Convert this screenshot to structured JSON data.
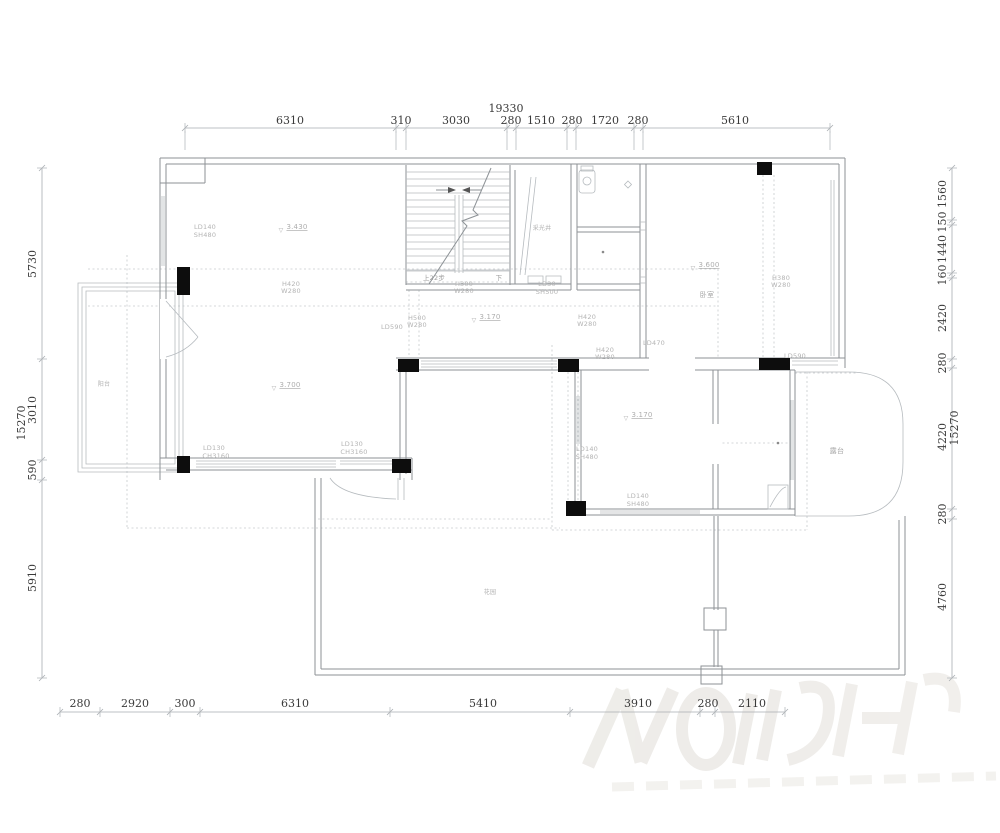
{
  "document": {
    "kind": "floor-plan-cad-drawing",
    "background": "#ffffff"
  },
  "drawing": {
    "line_color": "#8d9296",
    "thin_line_color": "#b6bbbf",
    "dash_color": "#c6cacd",
    "dim_line_color": "#a9adb1",
    "dim_text_color": "#3a3a3a",
    "annot_text_color": "#b3b3b3",
    "column_color": "#0d0d0d",
    "watermark_color": "#eae8e4"
  },
  "dimensions": {
    "top": {
      "total": "19330",
      "segments": [
        "6310",
        "310",
        "3030",
        "280",
        "1510",
        "280",
        "1720",
        "280",
        "5610"
      ]
    },
    "bottom": {
      "segments": [
        "280",
        "2920",
        "300",
        "6310",
        "5410",
        "3910",
        "280",
        "2110"
      ]
    },
    "left": {
      "total": "15270",
      "segments": [
        "5730",
        "3010",
        "590",
        "5910"
      ]
    },
    "right": {
      "total": "15270",
      "segments": [
        "1560",
        "150",
        "1440",
        "160",
        "2420",
        "280",
        "4220",
        "280",
        "4760"
      ]
    }
  },
  "elevations": [
    "3.430",
    "3.600",
    "3.170",
    "3.170",
    "3.700"
  ],
  "openings": [
    "LD140 SH480",
    "LD30 SH500",
    "LD590",
    "LD470",
    "LD590",
    "H300 W280",
    "H420 W280",
    "H500 W280",
    "H420 W280",
    "H420 W280",
    "H380 W280",
    "LD140 SH480",
    "LD140 SH480",
    "LD130 CH3160",
    "LD130 CH3160"
  ],
  "rooms": [
    "阳台",
    "卧室",
    "露台",
    "花园",
    "采光井"
  ],
  "stairs": {
    "up_label": "上22步",
    "down_label": "下"
  },
  "texts": [
    {
      "name": "dim-top-total",
      "text": "19330",
      "x": 506,
      "y": 112,
      "size": 11,
      "color": "#3a3a3a",
      "serif": true
    },
    {
      "name": "dim-top-1",
      "text": "6310",
      "x": 290,
      "y": 124,
      "size": 11,
      "color": "#3a3a3a",
      "serif": true
    },
    {
      "name": "dim-top-2",
      "text": "310",
      "x": 401,
      "y": 124,
      "size": 11,
      "color": "#3a3a3a",
      "serif": true
    },
    {
      "name": "dim-top-3",
      "text": "3030",
      "x": 456,
      "y": 124,
      "size": 11,
      "color": "#3a3a3a",
      "serif": true
    },
    {
      "name": "dim-top-4",
      "text": "280",
      "x": 511,
      "y": 124,
      "size": 11,
      "color": "#3a3a3a",
      "serif": true
    },
    {
      "name": "dim-top-5",
      "text": "1510",
      "x": 541,
      "y": 124,
      "size": 11,
      "color": "#3a3a3a",
      "serif": true
    },
    {
      "name": "dim-top-6",
      "text": "280",
      "x": 572,
      "y": 124,
      "size": 11,
      "color": "#3a3a3a",
      "serif": true
    },
    {
      "name": "dim-top-7",
      "text": "1720",
      "x": 605,
      "y": 124,
      "size": 11,
      "color": "#3a3a3a",
      "serif": true
    },
    {
      "name": "dim-top-8",
      "text": "280",
      "x": 638,
      "y": 124,
      "size": 11,
      "color": "#3a3a3a",
      "serif": true
    },
    {
      "name": "dim-top-9",
      "text": "5610",
      "x": 735,
      "y": 124,
      "size": 11,
      "color": "#3a3a3a",
      "serif": true
    },
    {
      "name": "dim-bottom-1",
      "text": "280",
      "x": 80,
      "y": 707,
      "size": 11,
      "color": "#3a3a3a",
      "serif": true
    },
    {
      "name": "dim-bottom-2",
      "text": "2920",
      "x": 135,
      "y": 707,
      "size": 11,
      "color": "#3a3a3a",
      "serif": true
    },
    {
      "name": "dim-bottom-3",
      "text": "300",
      "x": 185,
      "y": 707,
      "size": 11,
      "color": "#3a3a3a",
      "serif": true
    },
    {
      "name": "dim-bottom-4",
      "text": "6310",
      "x": 295,
      "y": 707,
      "size": 11,
      "color": "#3a3a3a",
      "serif": true
    },
    {
      "name": "dim-bottom-5",
      "text": "5410",
      "x": 483,
      "y": 707,
      "size": 11,
      "color": "#3a3a3a",
      "serif": true
    },
    {
      "name": "dim-bottom-6",
      "text": "3910",
      "x": 638,
      "y": 707,
      "size": 11,
      "color": "#3a3a3a",
      "serif": true
    },
    {
      "name": "dim-bottom-7",
      "text": "280",
      "x": 708,
      "y": 707,
      "size": 11,
      "color": "#3a3a3a",
      "serif": true
    },
    {
      "name": "dim-bottom-8",
      "text": "2110",
      "x": 752,
      "y": 707,
      "size": 11,
      "color": "#3a3a3a",
      "serif": true
    },
    {
      "name": "dim-left-total",
      "text": "15270",
      "x": 25,
      "y": 423,
      "size": 11,
      "color": "#3a3a3a",
      "serif": true,
      "rot": -90
    },
    {
      "name": "dim-left-1",
      "text": "5730",
      "x": 36,
      "y": 264,
      "size": 11,
      "color": "#3a3a3a",
      "serif": true,
      "rot": -90
    },
    {
      "name": "dim-left-2",
      "text": "3010",
      "x": 36,
      "y": 410,
      "size": 11,
      "color": "#3a3a3a",
      "serif": true,
      "rot": -90
    },
    {
      "name": "dim-left-3",
      "text": "590",
      "x": 36,
      "y": 470,
      "size": 11,
      "color": "#3a3a3a",
      "serif": true,
      "rot": -90
    },
    {
      "name": "dim-left-4",
      "text": "5910",
      "x": 36,
      "y": 578,
      "size": 11,
      "color": "#3a3a3a",
      "serif": true,
      "rot": -90
    },
    {
      "name": "dim-right-1",
      "text": "1560",
      "x": 946,
      "y": 194,
      "size": 11,
      "color": "#3a3a3a",
      "serif": true,
      "rot": -90
    },
    {
      "name": "dim-right-2",
      "text": "150",
      "x": 946,
      "y": 222,
      "size": 11,
      "color": "#3a3a3a",
      "serif": true,
      "rot": -90
    },
    {
      "name": "dim-right-3",
      "text": "1440",
      "x": 946,
      "y": 249,
      "size": 11,
      "color": "#3a3a3a",
      "serif": true,
      "rot": -90
    },
    {
      "name": "dim-right-4",
      "text": "160",
      "x": 946,
      "y": 275,
      "size": 11,
      "color": "#3a3a3a",
      "serif": true,
      "rot": -90
    },
    {
      "name": "dim-right-5",
      "text": "2420",
      "x": 946,
      "y": 318,
      "size": 11,
      "color": "#3a3a3a",
      "serif": true,
      "rot": -90
    },
    {
      "name": "dim-right-6",
      "text": "280",
      "x": 946,
      "y": 363,
      "size": 11,
      "color": "#3a3a3a",
      "serif": true,
      "rot": -90
    },
    {
      "name": "dim-right-7",
      "text": "4220",
      "x": 946,
      "y": 437,
      "size": 11,
      "color": "#3a3a3a",
      "serif": true,
      "rot": -90
    },
    {
      "name": "dim-right-total",
      "text": "15270",
      "x": 958,
      "y": 428,
      "size": 11,
      "color": "#3a3a3a",
      "serif": true,
      "rot": -90
    },
    {
      "name": "dim-right-8",
      "text": "280",
      "x": 946,
      "y": 514,
      "size": 11,
      "color": "#3a3a3a",
      "serif": true,
      "rot": -90
    },
    {
      "name": "dim-right-9",
      "text": "4760",
      "x": 946,
      "y": 597,
      "size": 11,
      "color": "#3a3a3a",
      "serif": true,
      "rot": -90
    },
    {
      "name": "label-window-ld140-a1",
      "text": "LD140",
      "x": 205,
      "y": 229,
      "size": 6.5
    },
    {
      "name": "label-window-ld140-a2",
      "text": "SH480",
      "x": 205,
      "y": 237,
      "size": 6.5
    },
    {
      "name": "elev-living",
      "text": "3.430",
      "x": 297,
      "y": 229,
      "size": 7,
      "color": "#adadad",
      "u": true
    },
    {
      "name": "elev-living-mark",
      "text": "▽",
      "x": 281,
      "y": 232,
      "size": 6,
      "color": "#adadad"
    },
    {
      "name": "label-h420-a1",
      "text": "H420",
      "x": 291,
      "y": 286,
      "size": 6.5
    },
    {
      "name": "label-h420-a2",
      "text": "W280",
      "x": 291,
      "y": 293,
      "size": 6.5
    },
    {
      "name": "label-h300-1",
      "text": "H300",
      "x": 464,
      "y": 286,
      "size": 6.5
    },
    {
      "name": "label-h300-2",
      "text": "W280",
      "x": 464,
      "y": 293,
      "size": 6.5
    },
    {
      "name": "label-ld30-1",
      "text": "LD30",
      "x": 547,
      "y": 286,
      "size": 6.5
    },
    {
      "name": "label-ld30-2",
      "text": "SH500",
      "x": 547,
      "y": 294,
      "size": 6.5
    },
    {
      "name": "label-h500-1",
      "text": "H500",
      "x": 417,
      "y": 320,
      "size": 6.5
    },
    {
      "name": "label-h500-2",
      "text": "W280",
      "x": 417,
      "y": 327,
      "size": 6.5
    },
    {
      "name": "label-ld590-left",
      "text": "LD590",
      "x": 392,
      "y": 329,
      "size": 6.5
    },
    {
      "name": "elev-corridor",
      "text": "3.170",
      "x": 490,
      "y": 319,
      "size": 7,
      "color": "#adadad",
      "u": true
    },
    {
      "name": "elev-corridor-mark",
      "text": "▽",
      "x": 474,
      "y": 322,
      "size": 6,
      "color": "#adadad"
    },
    {
      "name": "label-h420-b1",
      "text": "H420",
      "x": 587,
      "y": 319,
      "size": 6.5
    },
    {
      "name": "label-h420-b2",
      "text": "W280",
      "x": 587,
      "y": 326,
      "size": 6.5
    },
    {
      "name": "label-h420-c1",
      "text": "H420",
      "x": 605,
      "y": 352,
      "size": 6.5
    },
    {
      "name": "label-h420-c2",
      "text": "W280",
      "x": 605,
      "y": 359,
      "size": 6.5
    },
    {
      "name": "elev-bedroom",
      "text": "3.600",
      "x": 709,
      "y": 267,
      "size": 7,
      "color": "#adadad",
      "u": true
    },
    {
      "name": "elev-bedroom-mark",
      "text": "▽",
      "x": 693,
      "y": 270,
      "size": 6,
      "color": "#adadad"
    },
    {
      "name": "room-bedroom",
      "text": "卧室",
      "x": 707,
      "y": 297,
      "size": 7,
      "color": "#a8a8a8"
    },
    {
      "name": "label-h380-1",
      "text": "H380",
      "x": 781,
      "y": 280,
      "size": 6.5
    },
    {
      "name": "label-h380-2",
      "text": "W280",
      "x": 781,
      "y": 287,
      "size": 6.5
    },
    {
      "name": "label-ld470",
      "text": "LD470",
      "x": 654,
      "y": 345,
      "size": 6.5
    },
    {
      "name": "label-ld590-right",
      "text": "LD590",
      "x": 795,
      "y": 358,
      "size": 6.5
    },
    {
      "name": "elev-room2",
      "text": "3.170",
      "x": 642,
      "y": 417,
      "size": 7,
      "color": "#adadad",
      "u": true
    },
    {
      "name": "elev-room2-mark",
      "text": "▽",
      "x": 626,
      "y": 420,
      "size": 6,
      "color": "#adadad"
    },
    {
      "name": "elev-lower-living",
      "text": "3.700",
      "x": 290,
      "y": 387,
      "size": 7,
      "color": "#adadad",
      "u": true
    },
    {
      "name": "elev-lower-living-mark",
      "text": "▽",
      "x": 274,
      "y": 390,
      "size": 6,
      "color": "#adadad"
    },
    {
      "name": "label-ld140-b1",
      "text": "LD140",
      "x": 587,
      "y": 451,
      "size": 6.5
    },
    {
      "name": "label-ld140-b2",
      "text": "SH480",
      "x": 587,
      "y": 459,
      "size": 6.5
    },
    {
      "name": "label-ld140-c1",
      "text": "LD140",
      "x": 638,
      "y": 498,
      "size": 6.5
    },
    {
      "name": "label-ld140-c2",
      "text": "SH480",
      "x": 638,
      "y": 506,
      "size": 6.5
    },
    {
      "name": "label-ld130-a1",
      "text": "LD130",
      "x": 214,
      "y": 450,
      "size": 6.5
    },
    {
      "name": "label-ld130-a2",
      "text": "CH3160",
      "x": 216,
      "y": 458,
      "size": 6.5
    },
    {
      "name": "label-ld130-b1",
      "text": "LD130",
      "x": 352,
      "y": 446,
      "size": 6.5
    },
    {
      "name": "label-ld130-b2",
      "text": "CH3160",
      "x": 354,
      "y": 454,
      "size": 6.5
    },
    {
      "name": "room-balcony",
      "text": "阳台",
      "x": 104,
      "y": 386,
      "size": 6,
      "color": "#b0b0b0"
    },
    {
      "name": "room-terrace",
      "text": "露台",
      "x": 837,
      "y": 453,
      "size": 7,
      "color": "#a8a8a8"
    },
    {
      "name": "room-garden",
      "text": "花园",
      "x": 490,
      "y": 594,
      "size": 6,
      "color": "#b0b0b0"
    },
    {
      "name": "room-lightwell",
      "text": "采光井",
      "x": 542,
      "y": 230,
      "size": 6,
      "color": "#b0b0b0"
    },
    {
      "name": "stair-up-label",
      "text": "上22步",
      "x": 434,
      "y": 280,
      "size": 6.5,
      "color": "#9b9b9b"
    },
    {
      "name": "stair-down-label",
      "text": "下",
      "x": 499,
      "y": 280,
      "size": 6.5,
      "color": "#9b9b9b"
    }
  ]
}
